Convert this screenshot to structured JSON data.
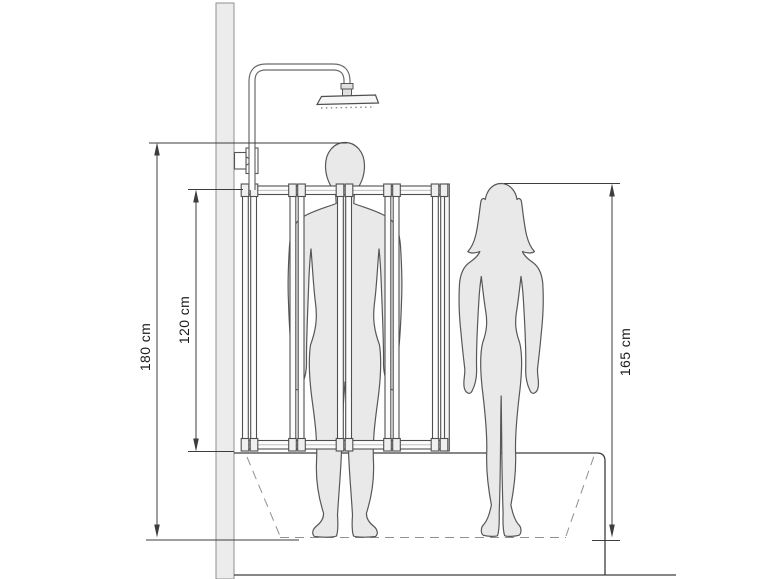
{
  "diagram": {
    "type": "technical-line-drawing",
    "measurements": [
      {
        "id": "shower-overall-height",
        "label": "180 cm",
        "orientation": "vertical",
        "side": "left-outer"
      },
      {
        "id": "bath-screen-height",
        "label": "120 cm",
        "orientation": "vertical",
        "side": "left-inner"
      },
      {
        "id": "figure-height",
        "label": "165 cm",
        "orientation": "vertical",
        "side": "right"
      }
    ],
    "colors": {
      "background": "#ffffff",
      "outline": "#3d3d3d",
      "silhouette_fill": "#e9e9e9",
      "silhouette_stroke": "#575757",
      "wall_fill": "#ececec",
      "dashed_line": "#909090"
    }
  }
}
